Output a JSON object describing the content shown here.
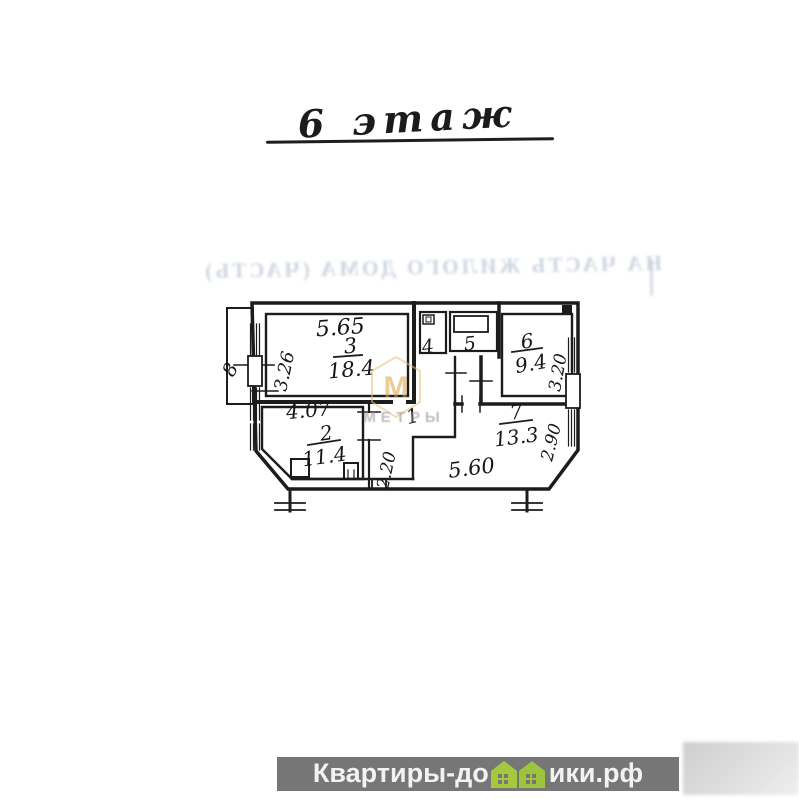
{
  "page": {
    "background": "#ffffff"
  },
  "title": {
    "text": "6 этаж"
  },
  "bleed_through": {
    "text": "НА ЧАСТЬ ЖИЛОГО ДОМА (ЧАСТЬ)",
    "color": "#a3b2c6"
  },
  "watermark": {
    "letter": "М",
    "label": "МЕТРЫ",
    "accent_color": "#dfa145",
    "label_color": "#9a8f96"
  },
  "plan": {
    "room1": {
      "number": "1"
    },
    "room2": {
      "number": "2",
      "area": "11.4"
    },
    "room3": {
      "number": "3",
      "area": "18.4"
    },
    "room4": {
      "number": "4"
    },
    "room5": {
      "number": "5"
    },
    "room6": {
      "number": "6",
      "area": "9.4"
    },
    "room7": {
      "number": "7",
      "area": "13.3"
    },
    "room8": {
      "number": "8"
    },
    "dims": {
      "top_room3": "5.65",
      "left_room3": "3.26",
      "top_room2": "4.07",
      "corridor": "2.20",
      "right_room6": "3.20",
      "right_room7": "2.90",
      "bottom_room7": "5.60"
    }
  },
  "footer": {
    "brand_prefix": "Квартиры-до",
    "brand_suffix": "ики.рф",
    "bar_color": "#767676",
    "text_color": "#f2f2f2",
    "house_color": "#a5c93e",
    "house_pane_color": "#767676"
  }
}
